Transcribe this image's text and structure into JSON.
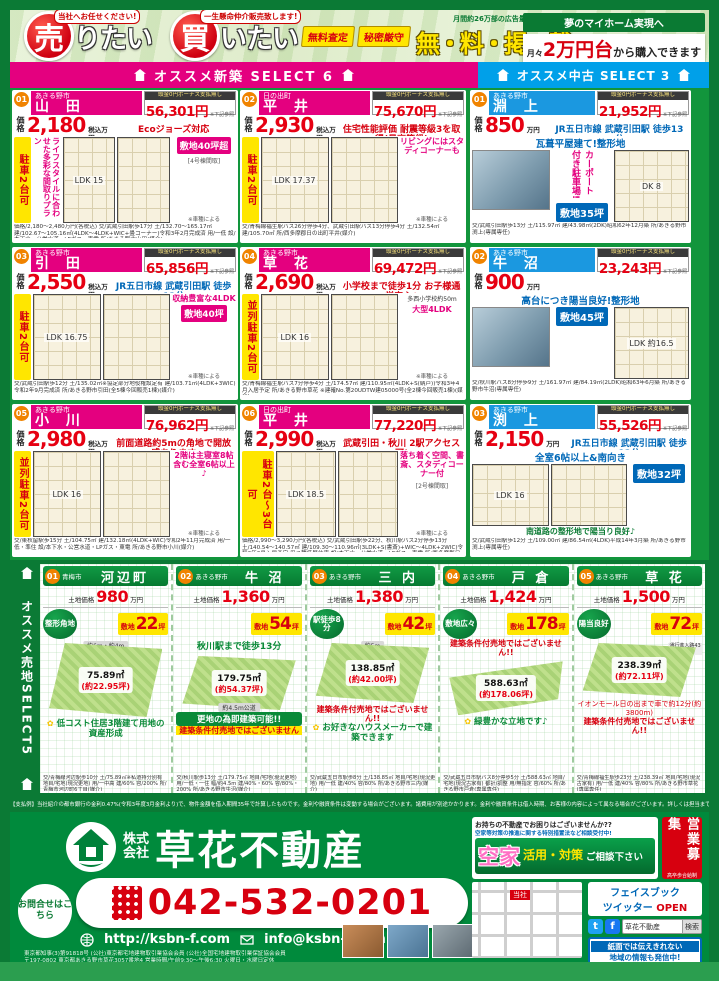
{
  "banner": {
    "sell_bubble": "当社へお任せください!",
    "sell_big": "売",
    "sell_rest": "りたい",
    "buy_bubble": "一生懸命仲介販売致します!",
    "buy_big": "買",
    "buy_rest": "いたい",
    "badge_free": "無料査定",
    "badge_secret": "秘密厳守",
    "ad_volume": "月間約26万部の広告量で",
    "free_listing": "無・料・掲・載",
    "dream": "夢のマイホーム実現へ",
    "monthly_prefix": "月々",
    "monthly_big": "2万円台",
    "monthly_suffix": "から購入できます"
  },
  "bars": {
    "new_label": "オススメ新築 SELECT 6",
    "used_label": "オススメ中古 SELECT 3"
  },
  "new_listings": [
    {
      "num": "01",
      "city": "あきる野市",
      "name": "山 田",
      "pay_label": "頭金0円ボーナス支払無し",
      "monthly": "56,301円",
      "pay_note": "※下記参照",
      "price_label": "価格",
      "price": "2,180",
      "price_unit": "税込万円〜",
      "feature": "Ecoジョーズ対応",
      "area_badge": "敷地40坪超",
      "side_text": "ライフスタイルに合わせた多彩な間取りプラン",
      "parking": "駐車2台可",
      "note": "※車種による",
      "plan_note": "[4号棟間取]",
      "plan1": "LDK 15",
      "fine": "価格/2,180〜2,480万円(各税込) 交/武蔵引田駅歩17分 土/132.70〜165.17㎡ 建/102.67〜105.16㎡(4LDK〜4LDK+WIC+畳コーナー)令和3年2月完成済 用/一低 設/本下水・公営水道・LPガス・東電 所/あきる野市山田(媒介)"
    },
    {
      "num": "02",
      "city": "日の出町",
      "name": "平 井",
      "pay_label": "頭金0円ボーナス支払無し",
      "monthly": "75,670円",
      "pay_note": "※下記参照",
      "price_label": "価格",
      "price": "2,930",
      "price_unit": "税込万円",
      "feature": "住宅性能評価 耐震等級3を取得(最高等級)",
      "callout": "リビングにはスタディコーナーも",
      "parking": "駐車2台可",
      "note": "※車種による",
      "plan1": "LDK 17.37",
      "fine": "交/青梅線福生駅バス26分停歩4分、武蔵引田駅バス13分停歩4分 土/132.54㎡ 建/105.70㎡ 所/西多摩郡日の出町平井(媒介)"
    },
    {
      "num": "03",
      "city": "あきる野市",
      "name": "引 田",
      "pay_label": "頭金0円ボーナス支払無し",
      "monthly": "65,856円",
      "pay_note": "※下記参照",
      "price_label": "価格",
      "price": "2,550",
      "price_unit": "税込万円",
      "station": "JR五日市線 武蔵引田駅 徒歩12分",
      "callout": "収納豊富な4LDK",
      "area_badge": "敷地40坪",
      "parking": "駐車2台可",
      "note": "※車種による",
      "plan1": "LDK 16.75",
      "fine": "交/武蔵引田駅歩12分 土/135.02㎡※協定部分地役権設定有 建/103.71㎡(4LDK+3WIC)令和2年9月完成済 所/あきる野市引田(全5棟今回販売1棟)(媒介)"
    },
    {
      "num": "04",
      "city": "あきる野市",
      "name": "草 花",
      "pay_label": "頭金0円ボーナス支払無し",
      "monthly": "69,472円",
      "pay_note": "※下記参照",
      "price_label": "価格",
      "price": "2,690",
      "price_unit": "税込万円",
      "feature": "小学校まで徒歩1分 お子様通学安心♪",
      "sub": "多西小学校約50m",
      "callout": "大型4LDK",
      "parking": "並列駐車2台可",
      "note": "※車種による",
      "plan1": "LDK 16",
      "fine": "交/青梅線福生駅バス7分停歩4分 土/174.57㎡ 建/110.95㎡(4LDK+S(納戸))令和3年4月入居予定 所/あきる野市草花 ※建確No.第20UDTW建05000号(全2棟今回販売1棟)(媒介)"
    },
    {
      "num": "05",
      "city": "あきる野市",
      "name": "小 川",
      "pay_label": "頭金0円ボーナス支払無し",
      "monthly": "76,962円",
      "pay_note": "※下記参照",
      "price_label": "価格",
      "price": "2,980",
      "price_unit": "税込万円",
      "feature": "前面道路約5mの角地で開放感あります",
      "callout": "2階は主寝室8帖含む全室6帖以上♪",
      "parking": "並列駐車2台可",
      "note": "※車種による",
      "plan1": "LDK 16",
      "fine": "交/東秋留駅歩15分 土/104.75㎡ 建/132.18㎡(4LDK+WIC)令和2年11月完成済 用/一低・準住 設/本下水・公営水道・LPガス・東電 所/あきる野市小川(媒介)"
    },
    {
      "num": "06",
      "city": "日の出町",
      "name": "平 井",
      "pay_label": "頭金0円ボーナス支払無し",
      "monthly": "77,220円",
      "pay_note": "※下記参照",
      "price_label": "価格",
      "price": "2,990",
      "price_unit": "税込万円〜",
      "feature": "武蔵引田・秋川 2駅アクセス可!",
      "callout": "落ち着く空間、書斎、スタディコーナー付",
      "parking": "駐車2台〜3台可",
      "note": "※車種による",
      "plan_note": "[2号棟間取]",
      "plan1": "LDK 18.5",
      "fine": "価格/2,990〜3,290万円(各税込) 交/武蔵引田駅歩22分、秋川駅バス2分停歩13分 土/140.54〜140.57㎡ 建/109.30〜110.96㎡(3LDK+S(書斎)+WIC〜4LDK+2WIC)令和3年3月入居予定 用/1種低層住専 設/本下水・公営水道・LPガス・東電 所/西多摩郡日の出町平井 ※建確No.第20UDTW建03421号他(全3棟販売)(媒介)"
    }
  ],
  "used_listings": [
    {
      "num": "01",
      "city": "あきる野市",
      "name": "淵 上",
      "pay_label": "頭金0円ボーナス支払無し",
      "monthly": "21,952円",
      "pay_note": "※下記参照",
      "price_label": "価格",
      "price": "850",
      "price_unit": "万円",
      "station": "JR五日市線 武蔵引田駅 徒歩13分",
      "callout": "瓦葺平屋建て!整形地",
      "side": "カーポート付き駐車場!",
      "area": "敷地35坪",
      "plan1": "DK 8",
      "fine": "交/武蔵引田駅歩13分 土/115.97㎡ 建/43.98㎡(2DK)昭和62年12月築 所/あきる野市渕上(専属専任)"
    },
    {
      "num": "02",
      "city": "あきる野市",
      "name": "牛 沼",
      "pay_label": "頭金0円ボーナス支払無し",
      "monthly": "23,243円",
      "pay_note": "※下記参照",
      "price_label": "価格",
      "price": "900",
      "price_unit": "万円",
      "callout": "高台につき陽当良好!整形地",
      "area": "敷地45坪",
      "plan1": "LDK 約16.5",
      "fine": "交/秋川駅バス8分停歩9分 土/161.97㎡ 建/84.19㎡(2LDK)昭和63年6月築 所/あきる野市牛沼(専属専任)"
    },
    {
      "num": "03",
      "city": "あきる野市",
      "name": "渕 上",
      "pay_label": "頭金0円ボーナス支払無し",
      "monthly": "55,526円",
      "pay_note": "※下記参照",
      "price_label": "価格",
      "price": "2,150",
      "price_unit": "万円",
      "station": "JR五日市線 武蔵引田駅 徒歩12分",
      "callout": "全室6帖以上&南向き",
      "area": "敷地32坪",
      "plan1": "LDK 16",
      "bottom": "南道路の整形地で陽当り良好♪",
      "fine": "交/武蔵引田駅歩12分 土/109.00㎡ 建/86.54㎡(4LDK)平成14年3月築 所/あきる野市渕上(専属専任)"
    }
  ],
  "land": {
    "sidebar": "オススメ売地SELECT5",
    "listings": [
      {
        "num": "01",
        "city": "青梅市",
        "name": "河辺町",
        "price_label": "土地価格",
        "price": "980",
        "price_unit": "万円",
        "circle": "整形角地",
        "tsubo_label": "敷地",
        "tsubo": "22",
        "tsubo_unit": "坪",
        "m2": "75.89㎡",
        "approx": "(約22.95坪)",
        "road": "約6m・約4m",
        "call": "低コスト住居3階建て用地の資産形成",
        "fine": "交/青梅線河辺駅歩10分 土/75.89㎡※私道持分別有 地目/宅地(現況更地) 用/一中高 建/60% 容/200% 所/青梅市河辺町6丁目(媒介)"
      },
      {
        "num": "02",
        "city": "あきる野市",
        "name": "牛 沼",
        "price_label": "土地価格",
        "price": "1,360",
        "price_unit": "万円",
        "tsubo_label": "敷地",
        "tsubo": "54",
        "tsubo_unit": "坪",
        "m2": "179.75㎡",
        "approx": "(約54.37坪)",
        "road": "約4.5m公道",
        "green": "秋川駅まで徒歩13分",
        "box": "更地の為即建築可能!!",
        "warn": "建築条件付売地ではございません",
        "fine": "交/秋川駅歩13分 土/179.75㎡ 地目/宅地(現況更地) 用/一低・一住 幅/約4.5m 建/40%・60% 容/80%・200% 所/あきる野市牛沼(媒介)"
      },
      {
        "num": "03",
        "city": "あきる野市",
        "name": "三 内",
        "price_label": "土地価格",
        "price": "1,380",
        "price_unit": "万円",
        "circle": "駅徒歩8分",
        "tsubo_label": "敷地",
        "tsubo": "42",
        "tsubo_unit": "坪",
        "m2": "138.85㎡",
        "approx": "(約42.00坪)",
        "road": "約5m",
        "warn": "建築条件付売地ではございません!!",
        "call": "お好きなハウスメーカーで建築できます",
        "fine": "交/武蔵五日市駅歩8分 土/138.85㎡ 地目/宅地(現況更地) 用/一低 建/40% 容/80% 所/あきる野市三内(媒介)"
      },
      {
        "num": "04",
        "city": "あきる野市",
        "name": "戸 倉",
        "price_label": "土地価格",
        "price": "1,424",
        "price_unit": "万円",
        "circle": "敷地広々",
        "tsubo_label": "敷地",
        "tsubo": "178",
        "tsubo_unit": "坪",
        "m2": "588.63㎡",
        "approx": "(約178.06坪)",
        "warn": "建築条件付売地ではございません!!",
        "call": "緑豊かな立地です♪",
        "fine": "交/武蔵五日市駅バス8分停歩5分 土/588.63㎡ 地目/宅地(現況古家有) 都計/調整 用/無指定 容/60% 所/あきる野市戸倉(専属専任)"
      },
      {
        "num": "05",
        "city": "あきる野市",
        "name": "草 花",
        "price_label": "土地価格",
        "price": "1,500",
        "price_unit": "万円",
        "circle": "陽当良好",
        "tsubo_label": "敷地",
        "tsubo": "72",
        "tsubo_unit": "坪",
        "m2": "238.39㎡",
        "approx": "(約72.11坪)",
        "lnote": "通行進入路43条但し書",
        "extra": "イオンモール日の出まで車で約12分(約3800m)",
        "warn": "建築条件付売地ではございません!!",
        "fine": "交/青梅線福生駅歩23分 土/238.39㎡ 地目/宅地(現況古家有) 用/一低 建/40% 容/80% 所/あきる野市草花(専属専任)"
      }
    ]
  },
  "disclaimer": "【支払例】当社紹介の都市銀行の金利0.47%(令和3年度3月金利より)で、物件金額を借入期間35年で計算したものです。金利や融資条件は変動する場合がございます。諸費用が別途かかります。金利や融資条件は借入時期、お客様の内容によって異なる場合がございます。詳しくは担当までお尋ね下さい。※頭金0円、ボーナス払いなし。",
  "footer": {
    "company_prefix1": "株式",
    "company_prefix2": "会社",
    "company_name": "草花不動産",
    "vacant_line1": "お持ちの不動産でお困りはございませんか??",
    "vacant_line2": "空家等対策の推進に関する特別措置法など相談受付中!",
    "akiya": "空家",
    "katsuyo": "活用・対策",
    "soudan": "ご相談下さい",
    "recruit1": "営業募集",
    "recruit2": "高卒歩合給制",
    "contact_label": "お問合せはこちら",
    "phone": "042-532-0201",
    "url": "http://ksbn-f.com",
    "email": "info@ksbn-f.com",
    "license": "東京都知事(3)第91818号 (公社)東京都宅地建物取引業協会会員 (公社)全国宅地建物取引業保証協会会員",
    "address": "〒197-0802 東京都あきる野市草花3057番地4 営業時間/午前9:30〜午後6:30 火曜日・水曜日定休",
    "map_here": "当社",
    "sns_line1": "フェイスブック",
    "sns_line2_a": "ツイッター ",
    "sns_line2_b": "OPEN",
    "search_query": "草花不動産",
    "search_button": "検索",
    "info_line1": "紙面では伝えきれない",
    "info_line2": "地域の情報も発信中!"
  }
}
